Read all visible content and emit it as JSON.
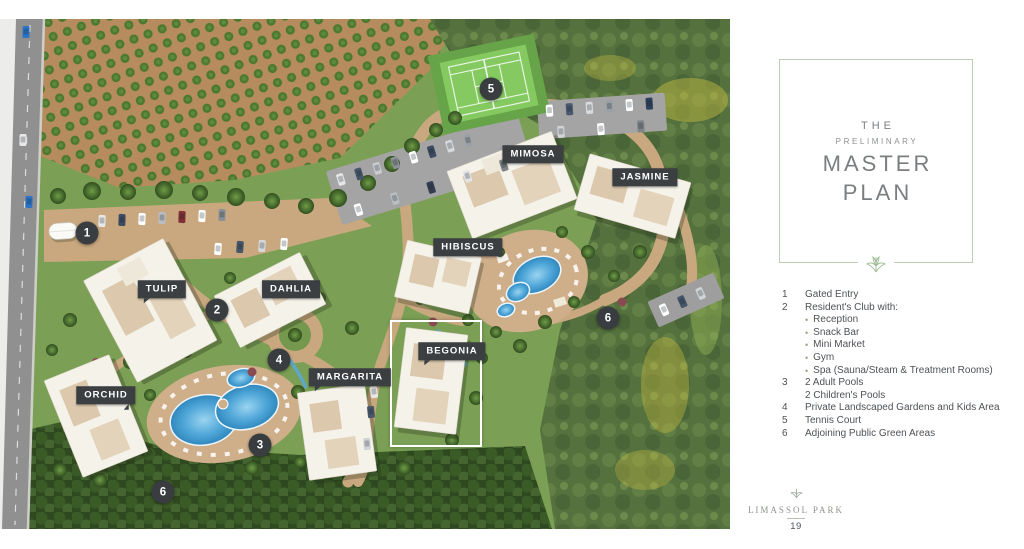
{
  "page": {
    "map": {
      "building_labels": [
        {
          "name": "MIMOSA"
        },
        {
          "name": "JASMINE"
        },
        {
          "name": "HIBISCUS"
        },
        {
          "name": "TULIP"
        },
        {
          "name": "DAHLIA"
        },
        {
          "name": "BEGONIA"
        },
        {
          "name": "MARGARITA"
        },
        {
          "name": "ORCHID"
        }
      ],
      "markers": [
        {
          "number": "1"
        },
        {
          "number": "2"
        },
        {
          "number": "3"
        },
        {
          "number": "4"
        },
        {
          "number": "5"
        },
        {
          "number": "6"
        },
        {
          "number": "6"
        }
      ]
    },
    "panel": {
      "title": {
        "the": "THE",
        "preliminary": "PRELIMINARY",
        "master": "MASTER",
        "plan": "PLAN"
      },
      "bullet_char": "•",
      "legend": [
        {
          "num": "1",
          "text": "Gated Entry"
        },
        {
          "num": "2",
          "text": "Resident's Club with:"
        },
        {
          "num": "",
          "text": "Reception"
        },
        {
          "num": "",
          "text": "Snack Bar"
        },
        {
          "num": "",
          "text": "Mini Market"
        },
        {
          "num": "",
          "text": "Gym"
        },
        {
          "num": "",
          "text": "Spa (Sauna/Steam & Treatment Rooms)"
        },
        {
          "num": "3",
          "text": "2 Adult Pools"
        },
        {
          "num": "",
          "text": "2 Children's Pools"
        },
        {
          "num": "4",
          "text": "Private Landscaped Gardens and Kids Area"
        },
        {
          "num": "5",
          "text": "Tennis Court"
        },
        {
          "num": "6",
          "text": "Adjoining Public Green Areas"
        }
      ],
      "footer": {
        "brand": "LIMASSOL PARK",
        "page_number": "19"
      }
    },
    "colors": {
      "accent_sage": "#bccfb4",
      "label_bg": "#3b3f42",
      "pool_blue": "#3f9bd8",
      "tennis_green": "#85ca60",
      "road_tan": "#c9a87f"
    }
  }
}
